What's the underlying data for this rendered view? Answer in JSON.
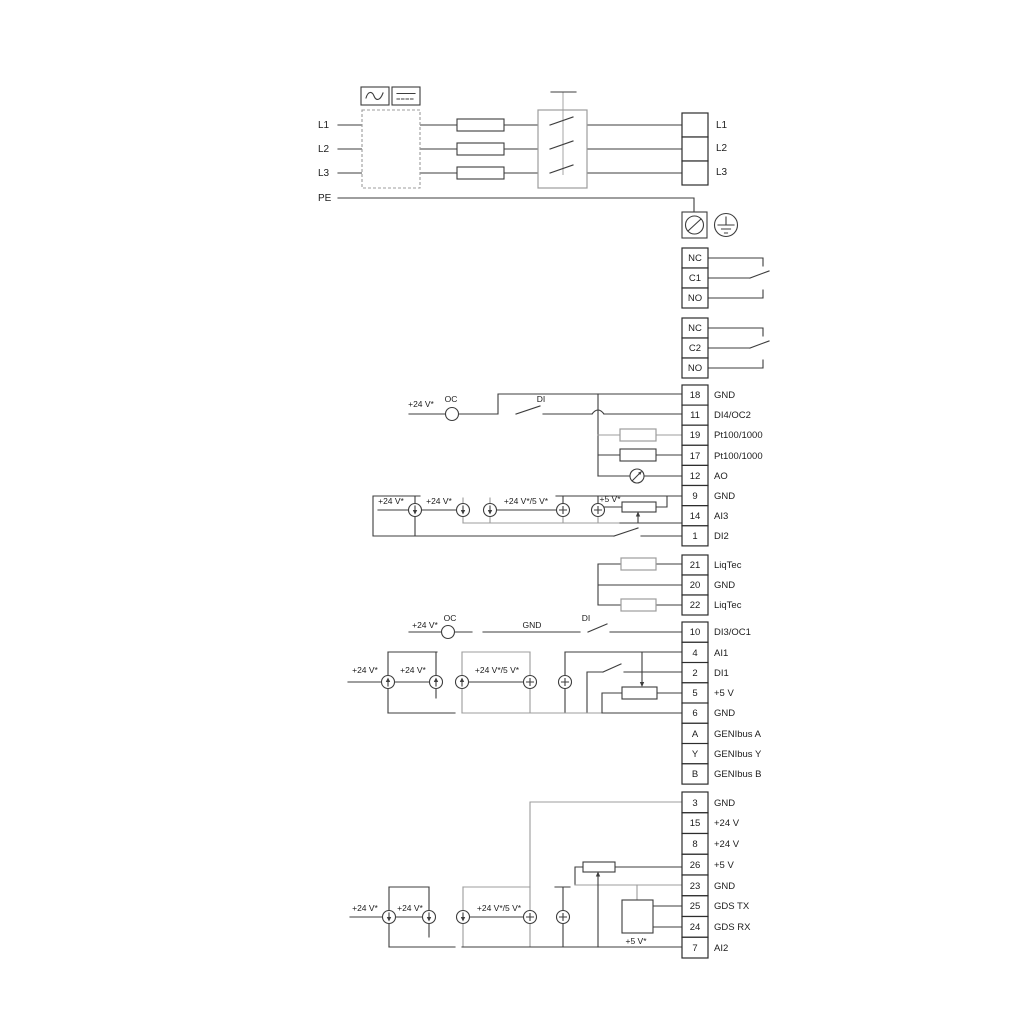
{
  "power": {
    "inputs": [
      "L1",
      "L2",
      "L3",
      "PE"
    ],
    "outputs": [
      "L1",
      "L2",
      "L3"
    ]
  },
  "relays": {
    "r1": [
      "NC",
      "C1",
      "NO"
    ],
    "r2": [
      "NC",
      "C2",
      "NO"
    ]
  },
  "stripD": {
    "rows": [
      {
        "n": "18",
        "l": "GND"
      },
      {
        "n": "11",
        "l": "DI4/OC2"
      },
      {
        "n": "19",
        "l": "Pt100/1000"
      },
      {
        "n": "17",
        "l": "Pt100/1000"
      },
      {
        "n": "12",
        "l": "AO"
      },
      {
        "n": "9",
        "l": "GND"
      },
      {
        "n": "14",
        "l": "AI3"
      },
      {
        "n": "1",
        "l": "DI2"
      }
    ]
  },
  "stripL": {
    "rows": [
      {
        "n": "21",
        "l": "LiqTec"
      },
      {
        "n": "20",
        "l": "GND"
      },
      {
        "n": "22",
        "l": "LiqTec"
      }
    ]
  },
  "stripF": {
    "rows": [
      {
        "n": "10",
        "l": "DI3/OC1"
      },
      {
        "n": "4",
        "l": "AI1"
      },
      {
        "n": "2",
        "l": "DI1"
      },
      {
        "n": "5",
        "l": "+5 V"
      },
      {
        "n": "6",
        "l": "GND"
      },
      {
        "n": "A",
        "l": "GENIbus A"
      },
      {
        "n": "Y",
        "l": "GENIbus Y"
      },
      {
        "n": "B",
        "l": "GENIbus B"
      }
    ]
  },
  "stripG": {
    "rows": [
      {
        "n": "3",
        "l": "GND"
      },
      {
        "n": "15",
        "l": "+24 V"
      },
      {
        "n": "8",
        "l": "+24 V"
      },
      {
        "n": "26",
        "l": "+5 V"
      },
      {
        "n": "23",
        "l": "GND"
      },
      {
        "n": "25",
        "l": "GDS TX"
      },
      {
        "n": "24",
        "l": "GDS RX"
      },
      {
        "n": "7",
        "l": "AI2"
      }
    ]
  },
  "annotations": {
    "v24": "+24 V*",
    "v24v5": "+24 V*/5 V*",
    "v5": "+5 V*",
    "oc": "OC",
    "di": "DI",
    "gnd": "GND"
  },
  "colors": {
    "wire": "#3d3d3d",
    "wire_gray": "#9c9c9c",
    "background": "#ffffff",
    "text": "#1c1c1c"
  }
}
